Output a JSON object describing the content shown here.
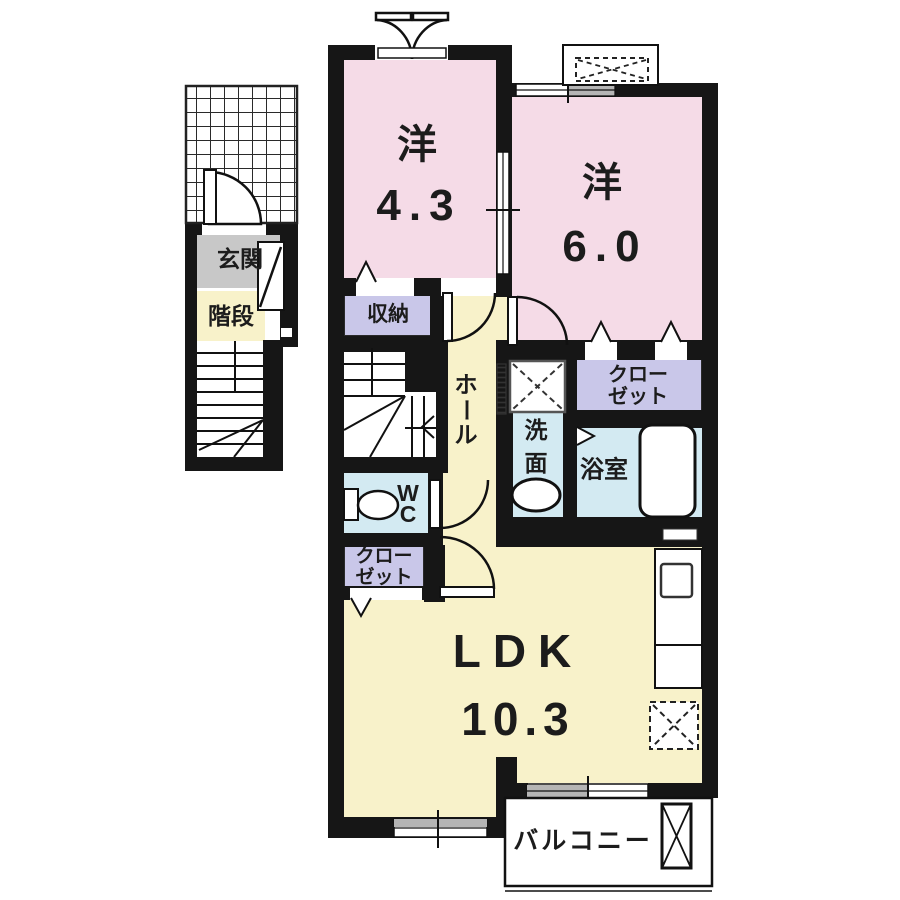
{
  "rooms": {
    "west43": {
      "label": "洋",
      "size": "4.3"
    },
    "west60": {
      "label": "洋",
      "size": "6.0"
    },
    "ldk": {
      "label": "LDK",
      "size": "10.3"
    },
    "entrance": "玄関",
    "stairs": "階段",
    "storage": "収納",
    "hall": [
      "ホ",
      "ー",
      "ル"
    ],
    "washroom": [
      "洗",
      "面"
    ],
    "bath": "浴室",
    "closet": {
      "line1": "クロー",
      "line2": "ゼット"
    },
    "wc": {
      "line1": "W",
      "line2": "C"
    },
    "balcony": "バルコニー"
  },
  "colors": {
    "room_pink": "#f5dbe7",
    "room_cream": "#f8f2ca",
    "room_lavender": "#c9c7e9",
    "room_blue": "#d3eaf2",
    "entrance_gray": "#c8c8c8",
    "window_gray": "#b5b5b5",
    "wall": "#161616"
  }
}
